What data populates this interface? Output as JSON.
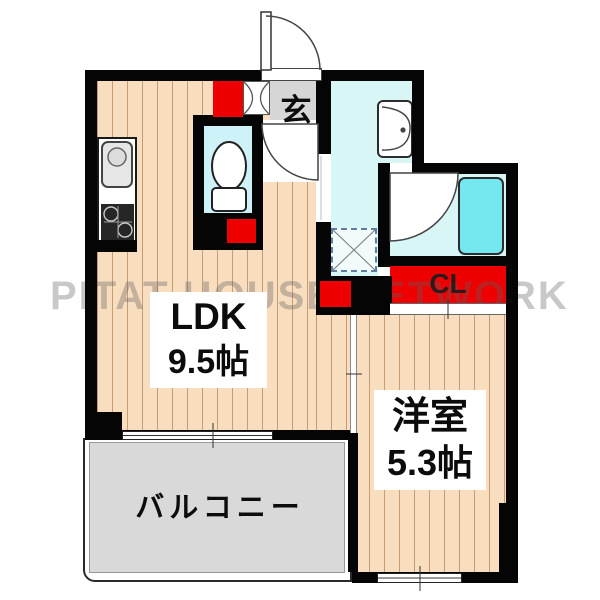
{
  "watermark": "PITAT HOUSE NETWORK",
  "rooms": {
    "ldk": {
      "name": "LDK",
      "size": "9.5帖"
    },
    "western": {
      "name": "洋室",
      "size": "5.3帖"
    },
    "balcony": {
      "label": "バルコニー"
    },
    "entrance": {
      "label": "玄"
    },
    "closet": {
      "label": "CL"
    }
  },
  "fixtures": {
    "toilet": "toilet",
    "bathtub": "bathtub",
    "washbasin": "washbasin",
    "kitchen_sink": "kitchen-sink",
    "gas_stove": "gas-stove",
    "washing_machine_space": "washing-machine-space"
  },
  "colors": {
    "floor": "#f8ddbe",
    "wall": "#050505",
    "wet_room": "#d9f6f7",
    "bathtub": "#74e7ef",
    "storage_red": "#ee0000",
    "balcony_gray": "#d9d9d9",
    "entrance_gray": "#d6d6d6",
    "watermark_gray": "#5f5f5f"
  }
}
